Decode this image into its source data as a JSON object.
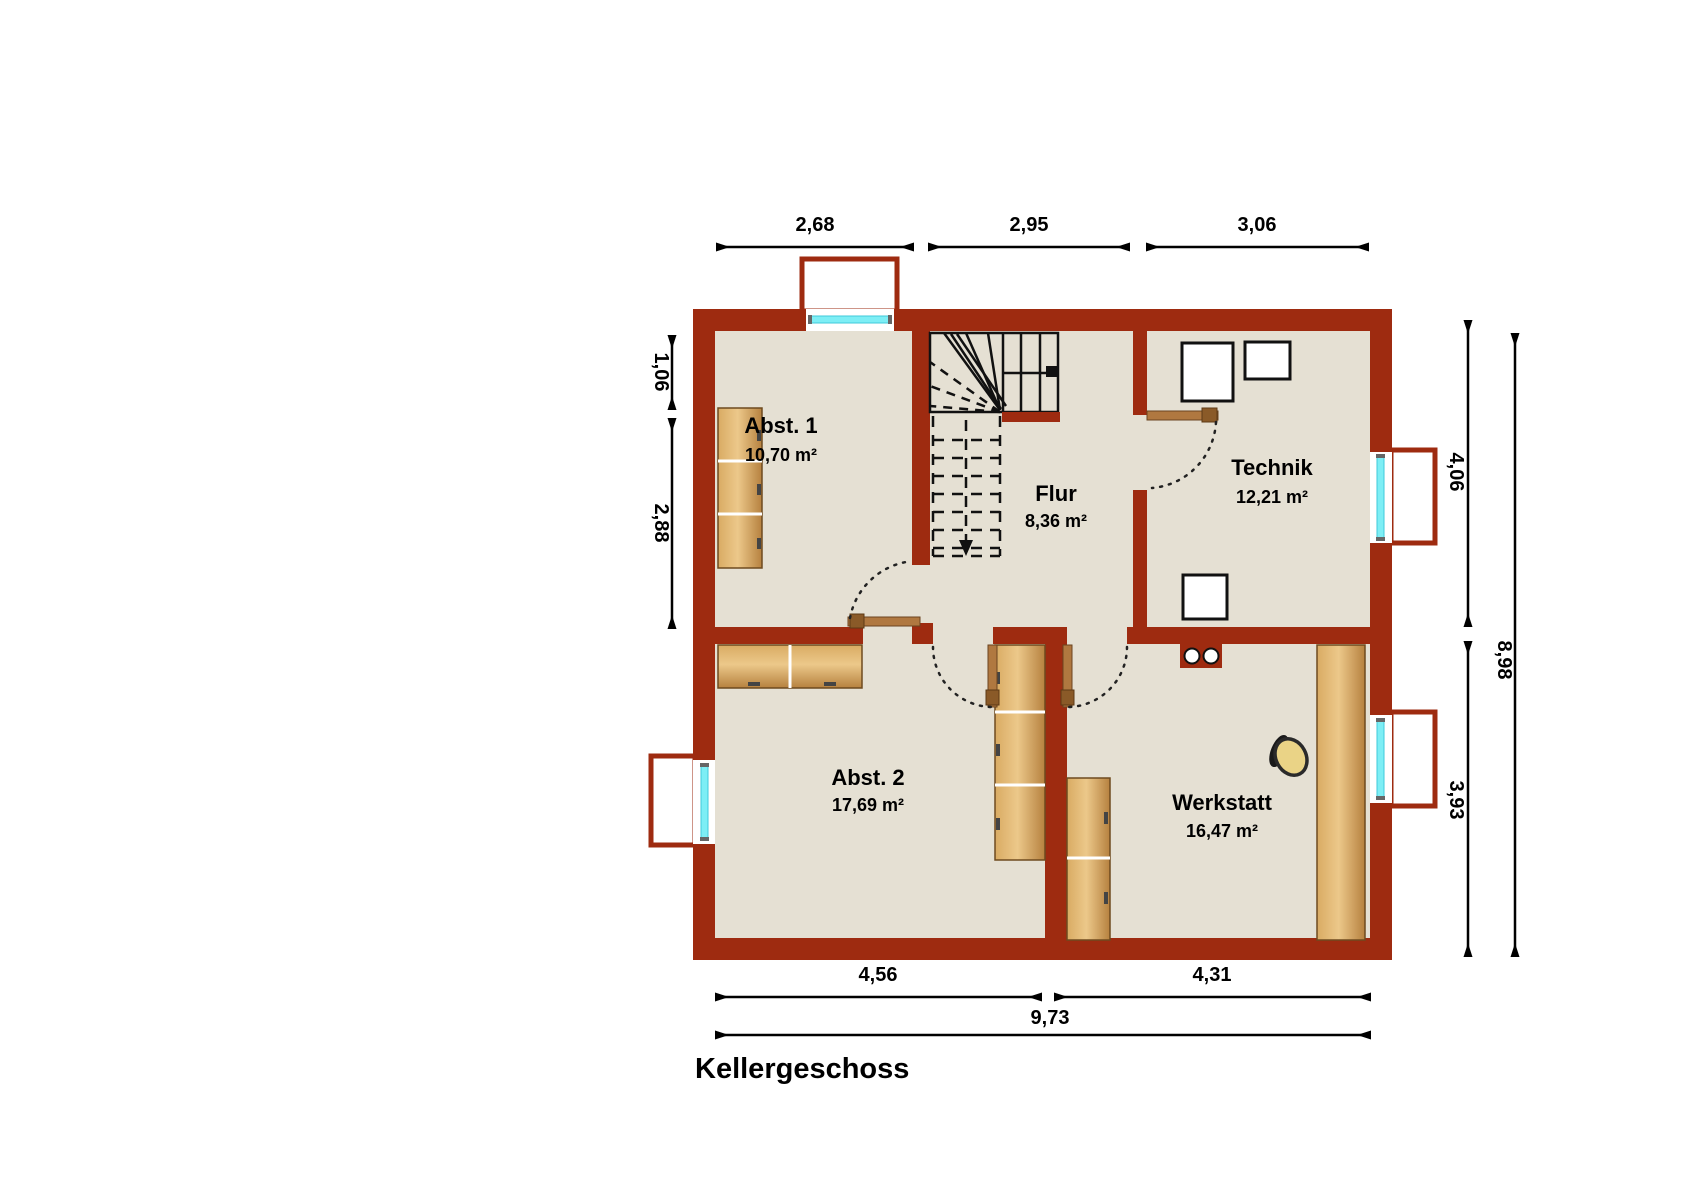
{
  "title": "Kellergeschoss",
  "rooms": {
    "abst1": {
      "name": "Abst. 1",
      "area": "10,70 m²"
    },
    "flur": {
      "name": "Flur",
      "area": "8,36 m²"
    },
    "technik": {
      "name": "Technik",
      "area": "12,21 m²"
    },
    "abst2": {
      "name": "Abst. 2",
      "area": "17,69 m²"
    },
    "werkstatt": {
      "name": "Werkstatt",
      "area": "16,47 m²"
    }
  },
  "dimensions": {
    "top_1": "2,68",
    "top_2": "2,95",
    "top_3": "3,06",
    "left_1": "1,06",
    "left_2": "2,88",
    "right_1": "4,06",
    "right_2": "3,93",
    "right_total": "8,98",
    "bottom_1": "4,56",
    "bottom_2": "4,31",
    "bottom_total": "9,73"
  },
  "colors": {
    "wall": "#9e2b10",
    "floor": "#e5e0d3",
    "glass": "#7deef5",
    "wood_light": "#ecc88a",
    "wood_dark": "#b6813f",
    "door": "#b07840"
  }
}
